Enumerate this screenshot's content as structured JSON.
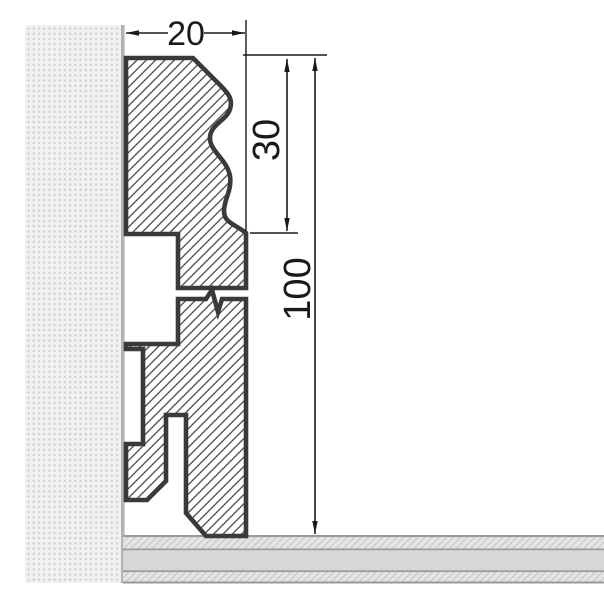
{
  "dimensions": {
    "width": "20",
    "upper_height": "30",
    "total_height": "100"
  },
  "colors": {
    "outline": "#3a3a3a",
    "hatch_line": "#4b4b4b",
    "dim": "#1a1a1a",
    "wall_bg": "#f1f1f1",
    "wall_dot": "#c8c8c8",
    "wall_border": "#b3b3b3",
    "floor_band_bg": "#e4e4e4",
    "floor_hatch_line": "#c4c4c4",
    "floor_solid": "#d7d7d7",
    "floor_border": "#9a9a9a"
  }
}
